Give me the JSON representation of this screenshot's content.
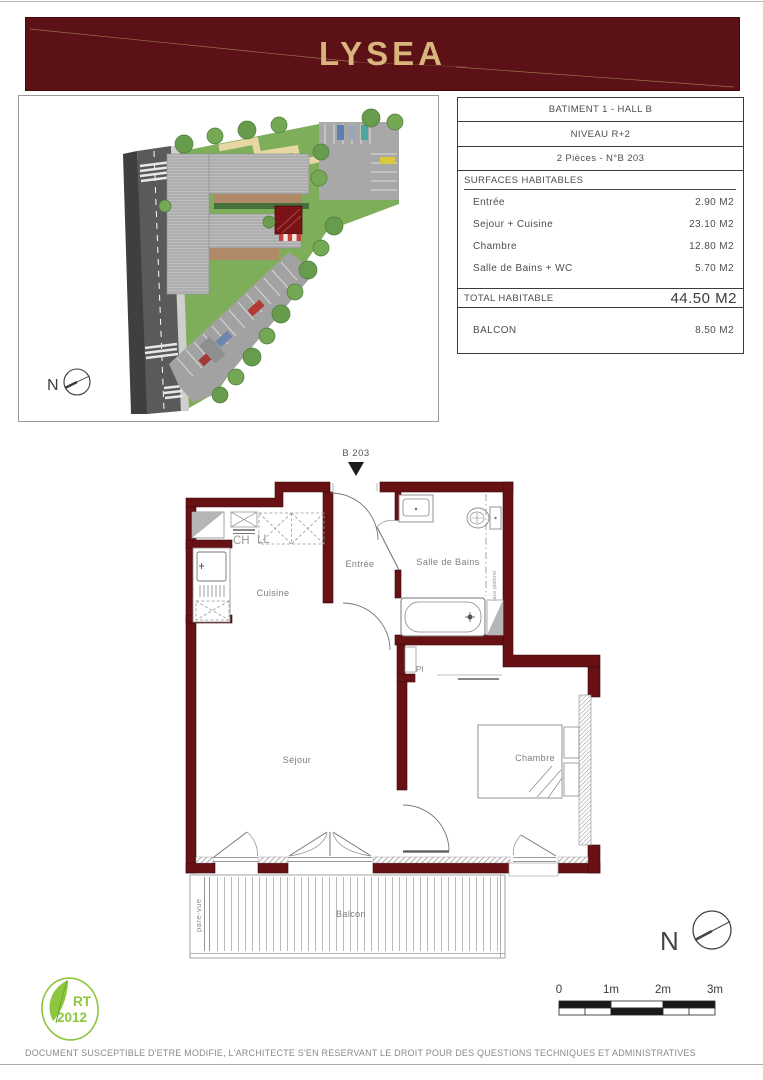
{
  "header": {
    "title": "LYSEA"
  },
  "site_plan": {
    "compass": "N"
  },
  "info_table": {
    "building": "BATIMENT 1 - HALL B",
    "level": "NIVEAU R+2",
    "unit": "2 Pièces - N°B 203",
    "surfaces_title": "SURFACES HABITABLES",
    "surfaces": [
      {
        "label": "Entrée",
        "value": "2.90 M2"
      },
      {
        "label": "Sejour + Cuisine",
        "value": "23.10 M2"
      },
      {
        "label": "Chambre",
        "value": "12.80 M2"
      },
      {
        "label": "Salle de Bains + WC",
        "value": "5.70 M2"
      }
    ],
    "total_label": "TOTAL HABITABLE",
    "total_value": "44.50 M2",
    "balcony_label": "BALCON",
    "balcony_value": "8.50 M2"
  },
  "floor_plan": {
    "unit_label": "B 203",
    "rooms": {
      "kitchen": "Cuisine",
      "entry": "Entrée",
      "bathroom": "Salle de Bains",
      "living": "Séjour",
      "bedroom": "Chambre",
      "balcony": "Balcon"
    },
    "annotations": {
      "boiler": "CH",
      "washer": "LL",
      "closet": "PI",
      "privacy_screen": "pare-vue",
      "false_ceiling": "faux plafond"
    }
  },
  "footer": {
    "energy_label_line1": "RT",
    "energy_label_line2": "2012",
    "compass": "N",
    "scale_ticks": [
      "0",
      "1m",
      "2m",
      "3m"
    ],
    "disclaimer": "DOCUMENT SUSCEPTIBLE D'ETRE MODIFIE, L'ARCHITECTE S'EN RESERVANT LE DROIT POUR DES QUESTIONS TECHNIQUES ET ADMINISTRATIVES"
  },
  "colors": {
    "maroon_banner": "#5c1116",
    "wall": "#671114",
    "gold": "#d9b57e",
    "rt_green": "#8dc63f",
    "line_gray": "#777777"
  }
}
